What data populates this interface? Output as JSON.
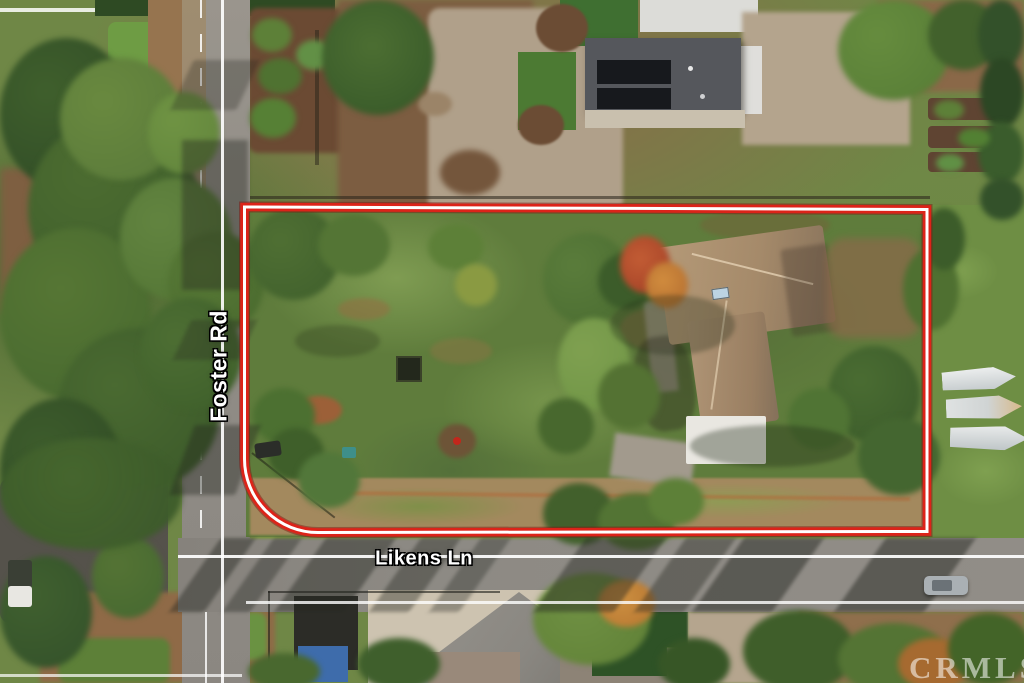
{
  "scene": {
    "labels": {
      "foster_rd": "Foster Rd",
      "likens_ln": "Likens Ln"
    },
    "watermark": "CRMLS",
    "colors": {
      "boundary_outer": "#dc2319",
      "boundary_inner": "#ffffff",
      "road_asphalt": "#908c86",
      "road_line": "#ffffff",
      "field_green": "#5f7c3c",
      "house_roof_tan": "#ab9071",
      "solar_roof_gray": "#55575c"
    }
  }
}
